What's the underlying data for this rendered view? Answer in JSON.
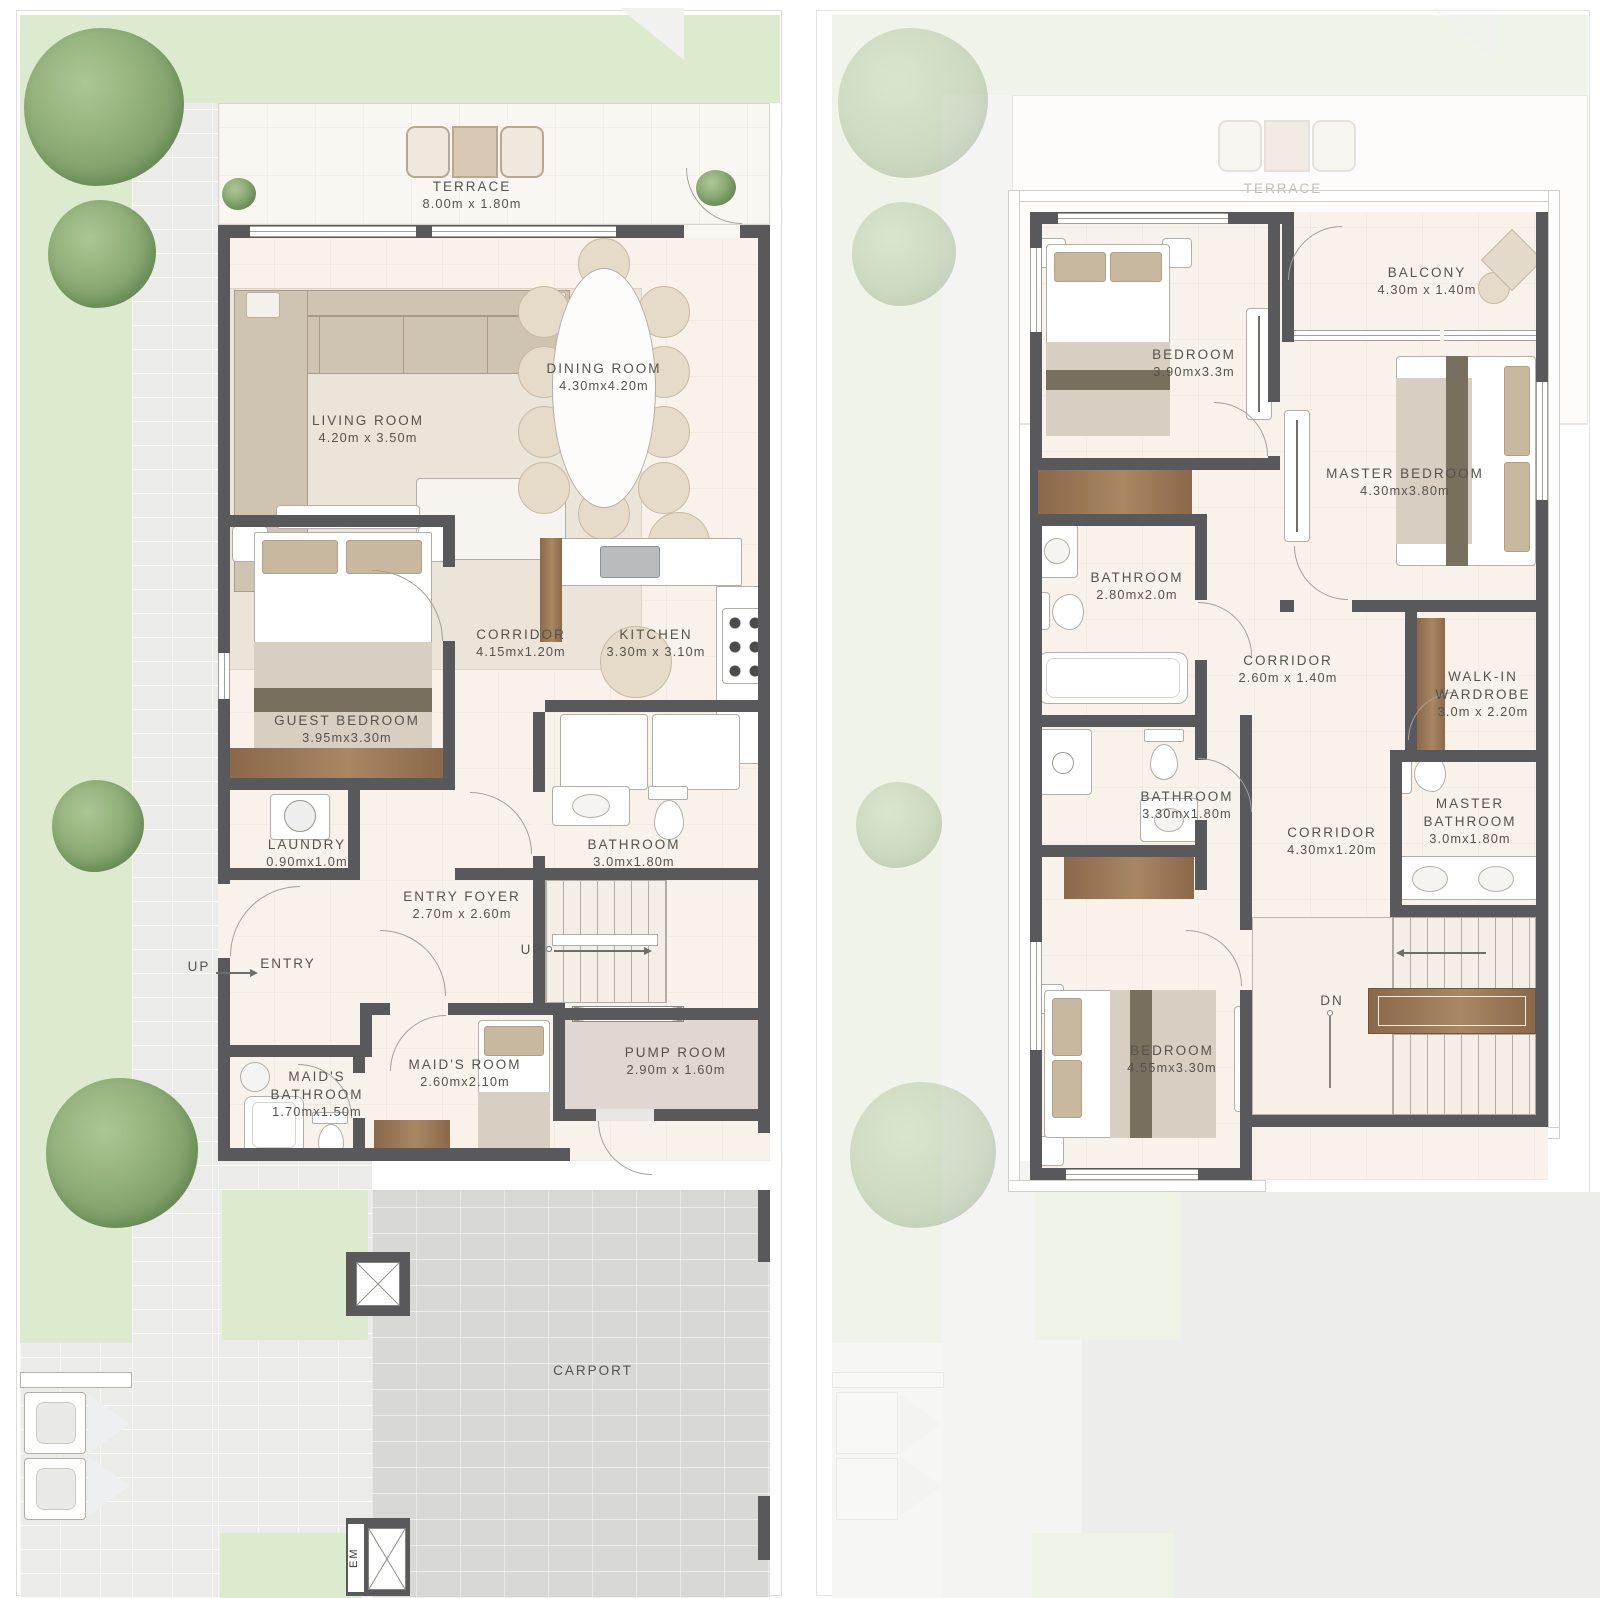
{
  "ground_floor": {
    "rooms": {
      "terrace": {
        "name": "TERRACE",
        "dims": "8.00m x 1.80m"
      },
      "living_room": {
        "name": "LIVING ROOM",
        "dims": "4.20m x 3.50m"
      },
      "dining_room": {
        "name": "DINING ROOM",
        "dims": "4.30mx4.20m"
      },
      "corridor": {
        "name": "CORRIDOR",
        "dims": "4.15mx1.20m"
      },
      "kitchen": {
        "name": "KITCHEN",
        "dims": "3.30m x 3.10m"
      },
      "guest_bedroom": {
        "name": "GUEST BEDROOM",
        "dims": "3.95mx3.30m"
      },
      "laundry": {
        "name": "LAUNDRY",
        "dims": "0.90mx1.0m"
      },
      "bathroom": {
        "name": "BATHROOM",
        "dims": "3.0mx1.80m"
      },
      "entry_foyer": {
        "name": "ENTRY FOYER",
        "dims": "2.70m x 2.60m"
      },
      "entry": {
        "name": "ENTRY"
      },
      "maids_room": {
        "name": "MAID'S ROOM",
        "dims": "2.60mx2.10m"
      },
      "maids_bathroom": {
        "name": "MAID'S BATHROOM",
        "dims": "1.70mx1.50m"
      },
      "pump_room": {
        "name": "PUMP ROOM",
        "dims": "2.90m x 1.60m"
      },
      "carport": {
        "name": "CARPORT"
      }
    },
    "annotations": {
      "up": "UP",
      "em": "EM"
    }
  },
  "first_floor": {
    "ghost_labels": {
      "terrace": "TERRACE"
    },
    "rooms": {
      "bedroom_top": {
        "name": "BEDROOM",
        "dims": "3.90mx3.3m"
      },
      "balcony": {
        "name": "BALCONY",
        "dims": "4.30m x 1.40m"
      },
      "master_bedroom": {
        "name": "MASTER BEDROOM",
        "dims": "4.30mx3.80m"
      },
      "bathroom_top": {
        "name": "BATHROOM",
        "dims": "2.80mx2.0m"
      },
      "corridor_upper": {
        "name": "CORRIDOR",
        "dims": "2.60m x 1.40m"
      },
      "walk_in_wardrobe": {
        "name": "WALK-IN WARDROBE",
        "dims": "3.0m x 2.20m"
      },
      "bathroom_mid": {
        "name": "BATHROOM",
        "dims": "3.30mx1.80m"
      },
      "corridor_lower": {
        "name": "CORRIDOR",
        "dims": "4.30mx1.20m"
      },
      "master_bathroom": {
        "name": "MASTER BATHROOM",
        "dims": "3.0mx1.80m"
      },
      "bedroom_bottom": {
        "name": "BEDROOM",
        "dims": "4.55mx3.30m"
      }
    },
    "annotations": {
      "dn": "DN"
    }
  },
  "colors": {
    "wall": "#59595b",
    "lawn": "#dcebce",
    "floor_cream": "#f8f2ea",
    "carport_gray": "#d8d8d6",
    "wood_brown": "#9b7a59",
    "label_text": "#55534d"
  }
}
